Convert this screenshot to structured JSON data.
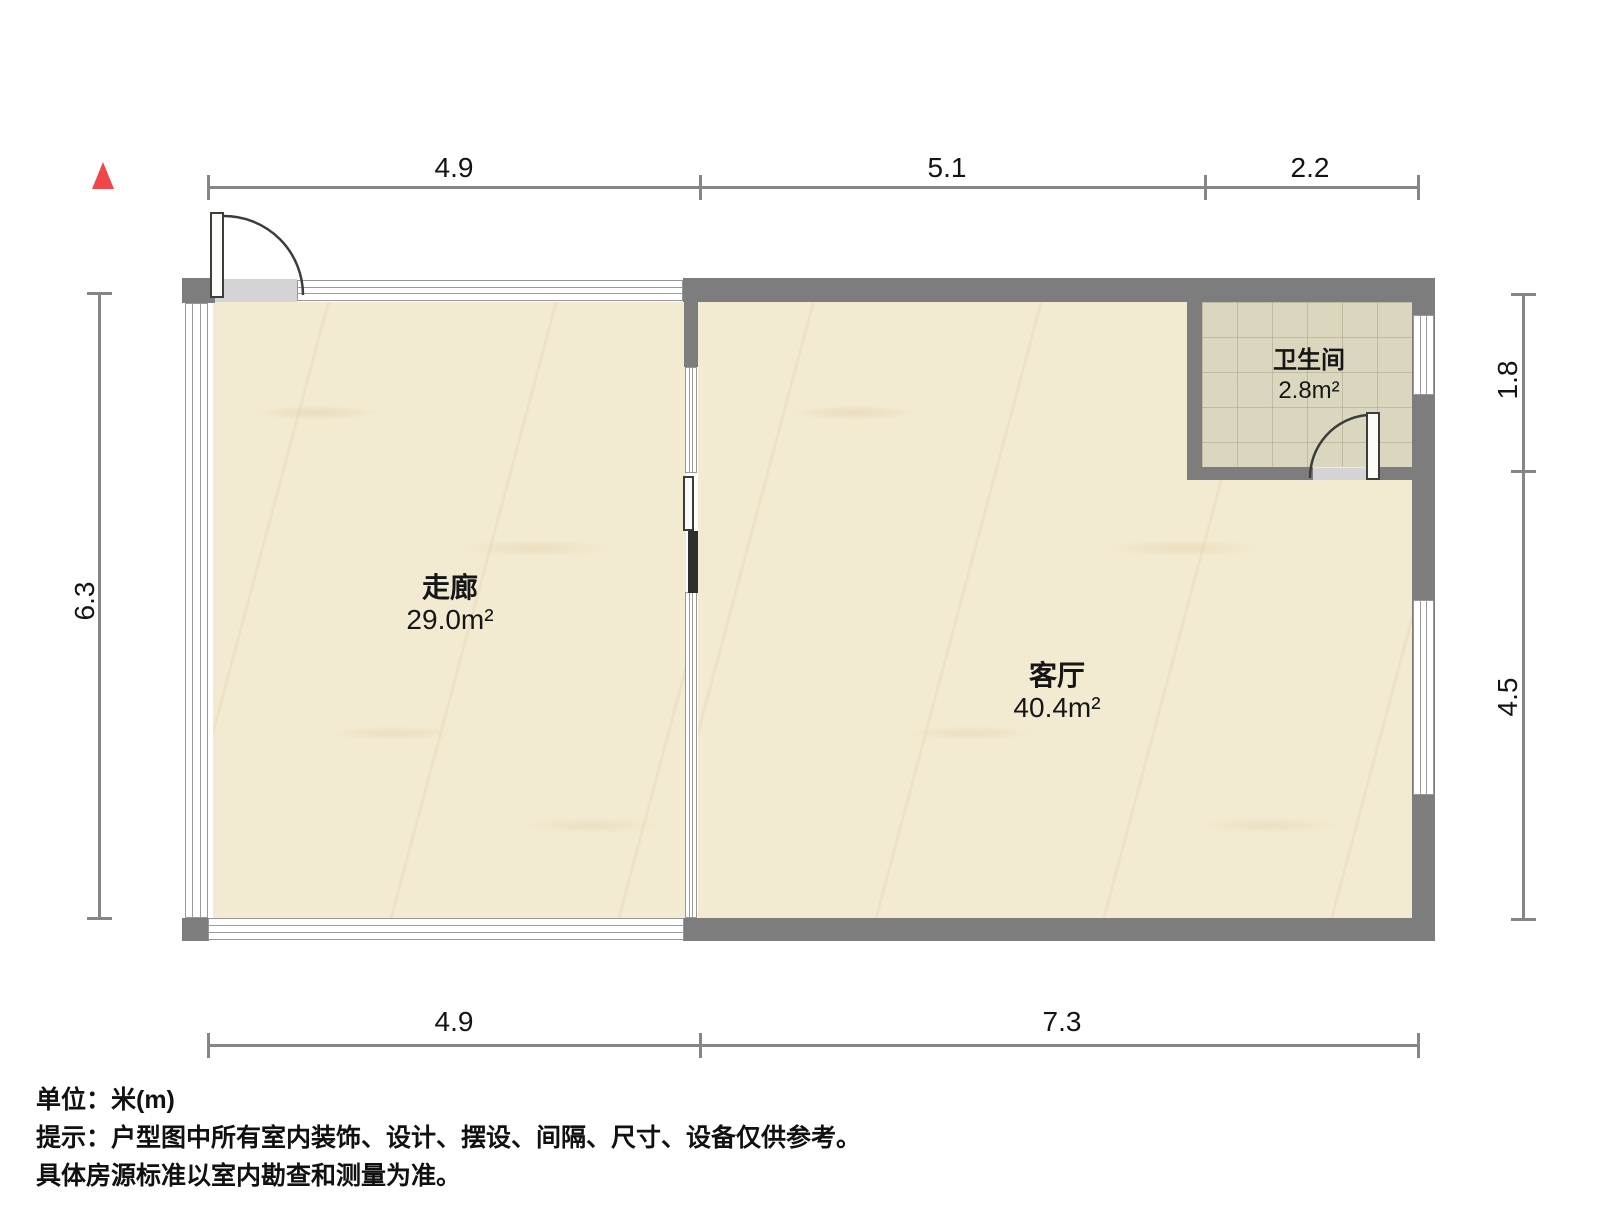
{
  "icons": {
    "north_arrow_icon": "red-triangle-up"
  },
  "colors": {
    "wall": "#7d7d7d",
    "floor_marble": "#f2ead1",
    "floor_tile": "#dbd7bf",
    "dimension_line": "#868686",
    "north_arrow": "#ef4649",
    "door": "#3c3c3c"
  },
  "dimensions": {
    "top": [
      "4.9",
      "5.1",
      "2.2"
    ],
    "bottom": [
      "4.9",
      "7.3"
    ],
    "left": [
      "6.3"
    ],
    "right": [
      "1.8",
      "4.5"
    ]
  },
  "rooms": [
    {
      "name": "走廊",
      "area": "29.0m²"
    },
    {
      "name": "客厅",
      "area": "40.4m²"
    },
    {
      "name": "卫生间",
      "area": "2.8m²"
    }
  ],
  "notes": {
    "unit": "单位：米(m)",
    "tip1": "提示：户型图中所有室内装饰、设计、摆设、间隔、尺寸、设备仅供参考。",
    "tip2": "具体房源标准以室内勘查和测量为准。"
  }
}
